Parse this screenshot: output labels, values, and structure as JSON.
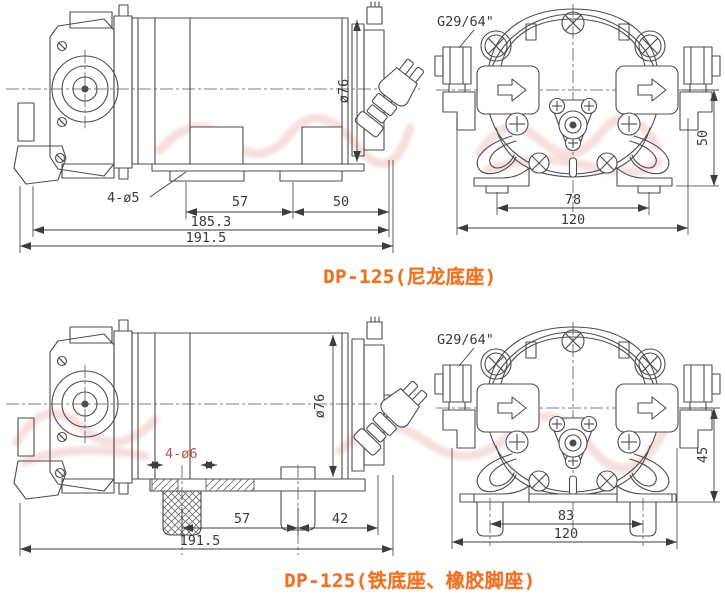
{
  "titles": {
    "top": "DP-125(尼龙底座)",
    "bottom": "DP-125(铁底座、橡胶脚座)"
  },
  "top_side": {
    "diameter": "ø76",
    "holes": "4-ø5",
    "foot_pitch": "57",
    "right_offset": "50",
    "base_length": "185.3",
    "overall_length": "191.5"
  },
  "top_front": {
    "fitting": "G29/64\"",
    "center_height": "50",
    "foot_pitch": "78",
    "overall_width": "120"
  },
  "bottom_side": {
    "diameter": "ø76",
    "holes": "4-ø6",
    "foot_pitch": "57",
    "right_offset": "42",
    "overall_length": "191.5"
  },
  "bottom_front": {
    "fitting": "G29/64\"",
    "center_height": "45",
    "foot_pitch": "83",
    "overall_width": "120"
  },
  "colors": {
    "background": "#ffffff",
    "line": "#4d4d4d",
    "dim_text": "#3a3a3a",
    "title": "#ee7320",
    "red_label": "#b85048",
    "watermark": "#cd4a3a"
  }
}
